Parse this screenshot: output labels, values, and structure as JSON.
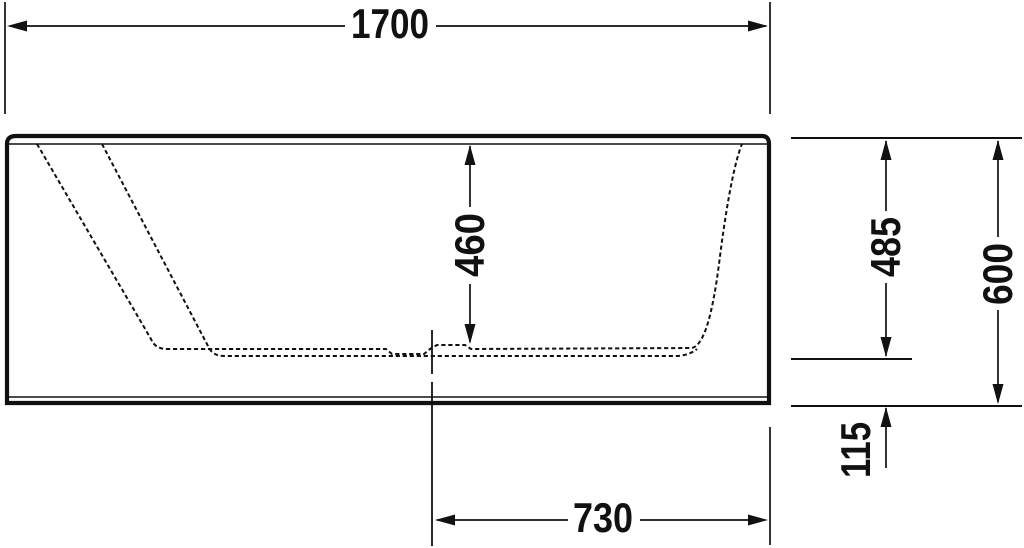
{
  "drawing": {
    "kind": "technical-dimension-drawing",
    "subject": "bathtub-side-section",
    "background_color": "#ffffff",
    "line_color": "#111111",
    "dimensions": {
      "overall_length": "1700",
      "inner_depth": "460",
      "rim_to_underside": "485",
      "overall_height": "600",
      "base_height": "115",
      "center_to_end": "730"
    }
  }
}
